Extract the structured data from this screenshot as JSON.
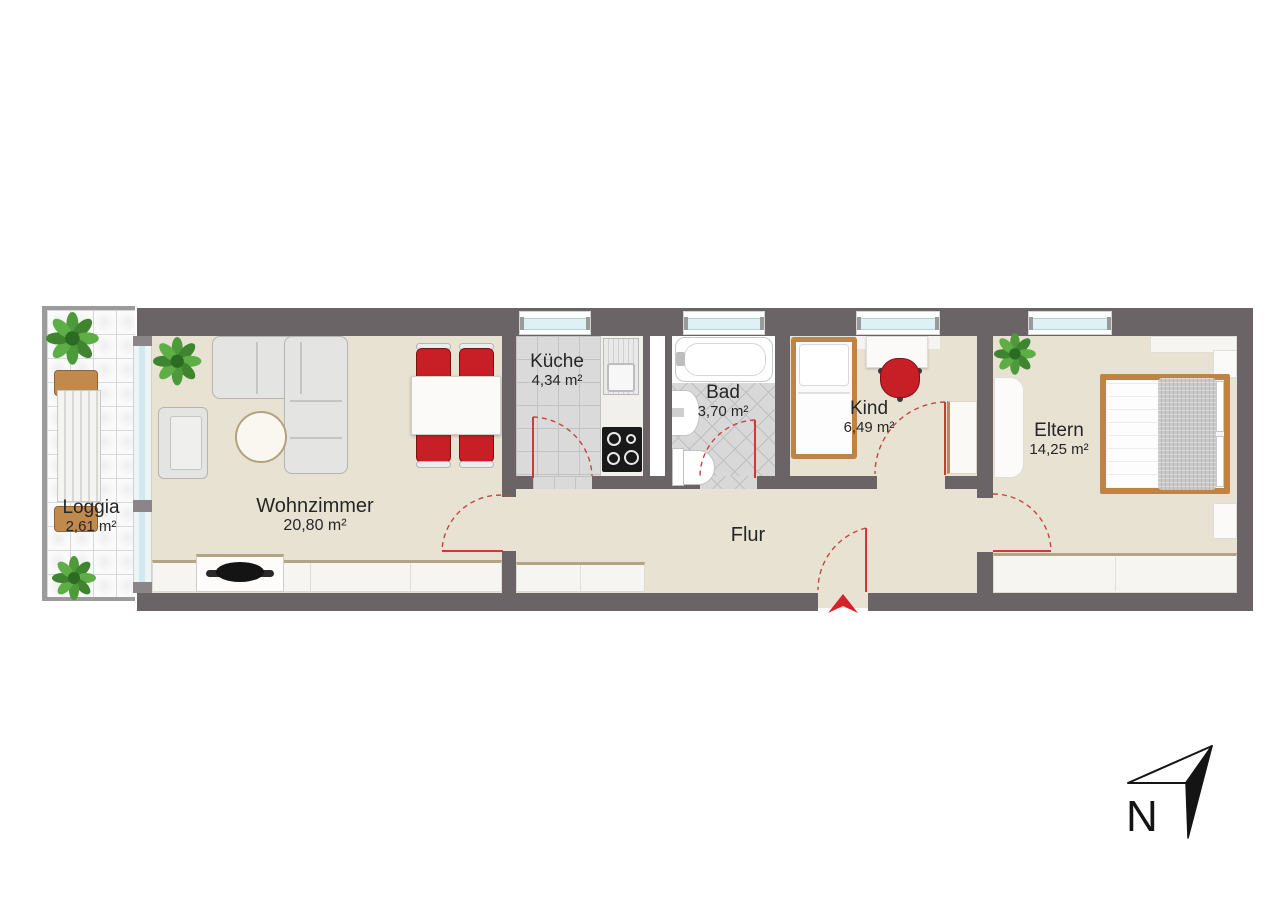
{
  "rooms": {
    "loggia": {
      "name": "Loggia",
      "area": "2,61 m²"
    },
    "wohnzimmer": {
      "name": "Wohnzimmer",
      "area": "20,80 m²"
    },
    "kueche": {
      "name": "Küche",
      "area": "4,34 m²"
    },
    "bad": {
      "name": "Bad",
      "area": "3,70 m²"
    },
    "kind": {
      "name": "Kind",
      "area": "6,49 m²"
    },
    "eltern": {
      "name": "Eltern",
      "area": "14,25 m²"
    },
    "flur": {
      "name": "Flur"
    }
  },
  "compass": {
    "label": "N"
  },
  "palette": {
    "wall": "#6b6467",
    "floor_beige": "#e8e2d3",
    "tile_gray": "#dadada",
    "accent_red": "#c81f27",
    "door_red": "#cd3a31",
    "wood": "#bf8445",
    "window_glass": "#def1f3",
    "sideboard_top": "#b3a583"
  }
}
